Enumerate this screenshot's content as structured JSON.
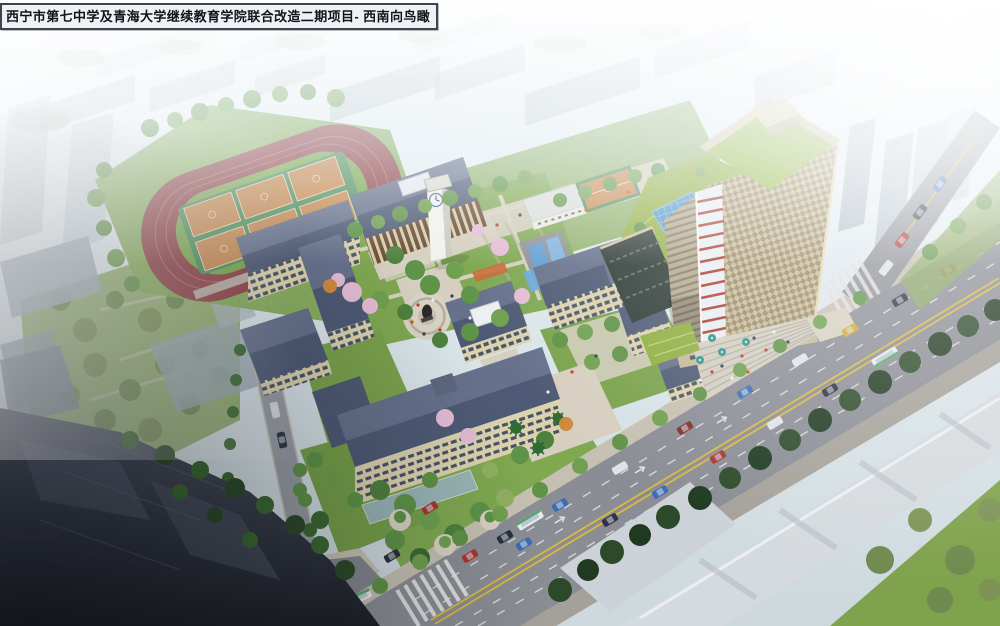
{
  "meta": {
    "width_px": 1000,
    "height_px": 626
  },
  "title_bar": {
    "text": "西宁市第七中学及青海大学继续教育学院联合改造二期项目- 西南向鸟瞰"
  },
  "scene": {
    "kind": "architectural aerial rendering (bird's-eye view)",
    "project_name": "西宁市第七中学及青海大学继续教育学院联合改造二期项目",
    "view_label": "西南向鸟瞰",
    "basketball_courts_on_field": 6,
    "visible_features": [
      "运动场跑道与篮球场",
      "礼堂",
      "钟楼",
      "教学楼组团",
      "中心雕塑广场",
      "景观叠水",
      "高层塔楼(绿化屋面)",
      "城市道路与车流",
      "樱花树与绿化"
    ]
  },
  "palette": {
    "sky_top": "#f3f8fb",
    "sky_bottom": "#d9e4ea",
    "haze_white": "#f6fafc",
    "track_red": "#8e4146",
    "infield_green": "#79a74f",
    "court_orange": "#c68a52",
    "court_mat_green": "#4f8f5e",
    "lawn_green": "#7fa851",
    "roof_slate": "#4e5a75",
    "facade_beige": "#dcd2ae",
    "paving_light": "#d6cfc0",
    "road_gray": "#8b8d95",
    "road_line_yellow": "#d9ba3e",
    "marking_white": "#e3e3e3",
    "tower_facade": "#cdbb92",
    "tower_side": "#b5a98c",
    "tower_roof_green": "#95b944",
    "podium_green": "#8fae3f",
    "glass_blue": "#4f93cc",
    "water_blue": "#5f9fd6",
    "accent_red": "#a93c30",
    "massing_white": "#d5dade",
    "massing_gray": "#aab6c2",
    "blossom_pink": "#e4bcd4",
    "title_bg": "#eef2f6",
    "title_border": "#3f444b",
    "title_text": "#111418"
  }
}
